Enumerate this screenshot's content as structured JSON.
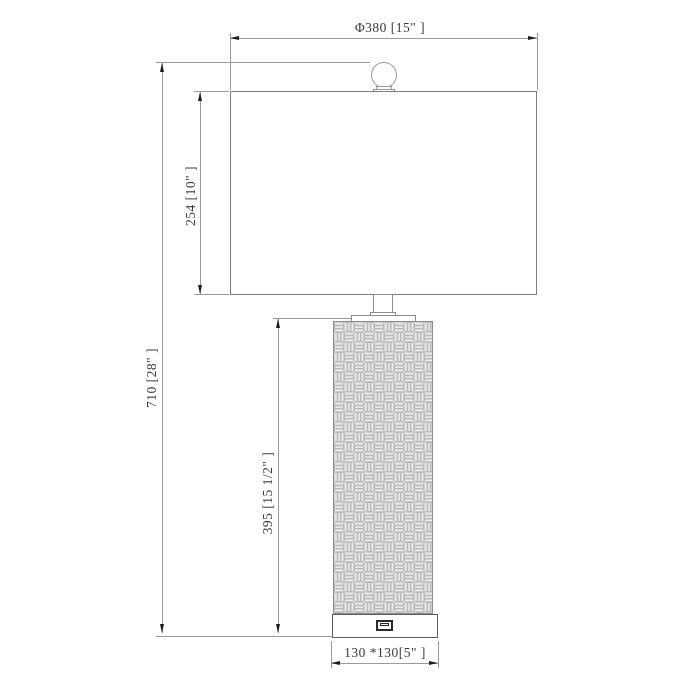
{
  "drawing_type": "table-lamp-dimension-diagram",
  "labels": {
    "shade_width": "Φ380 [15\"  ]",
    "overall_height": "710 [28\"  ]",
    "shade_height": "254 [10\"  ]",
    "body_height": "395 [15 1/2\"  ]",
    "base_size": "130 *130[5\"  ]"
  },
  "icons": {
    "usb_port": "usb-port-icon"
  },
  "colors": {
    "background": "#ffffff",
    "object_line": "#8d8d8d",
    "base_line": "#5e5e5e",
    "dimension_line": "#9a9a9a",
    "arrow": "#1c1c1c",
    "text": "#3c3c3c"
  }
}
